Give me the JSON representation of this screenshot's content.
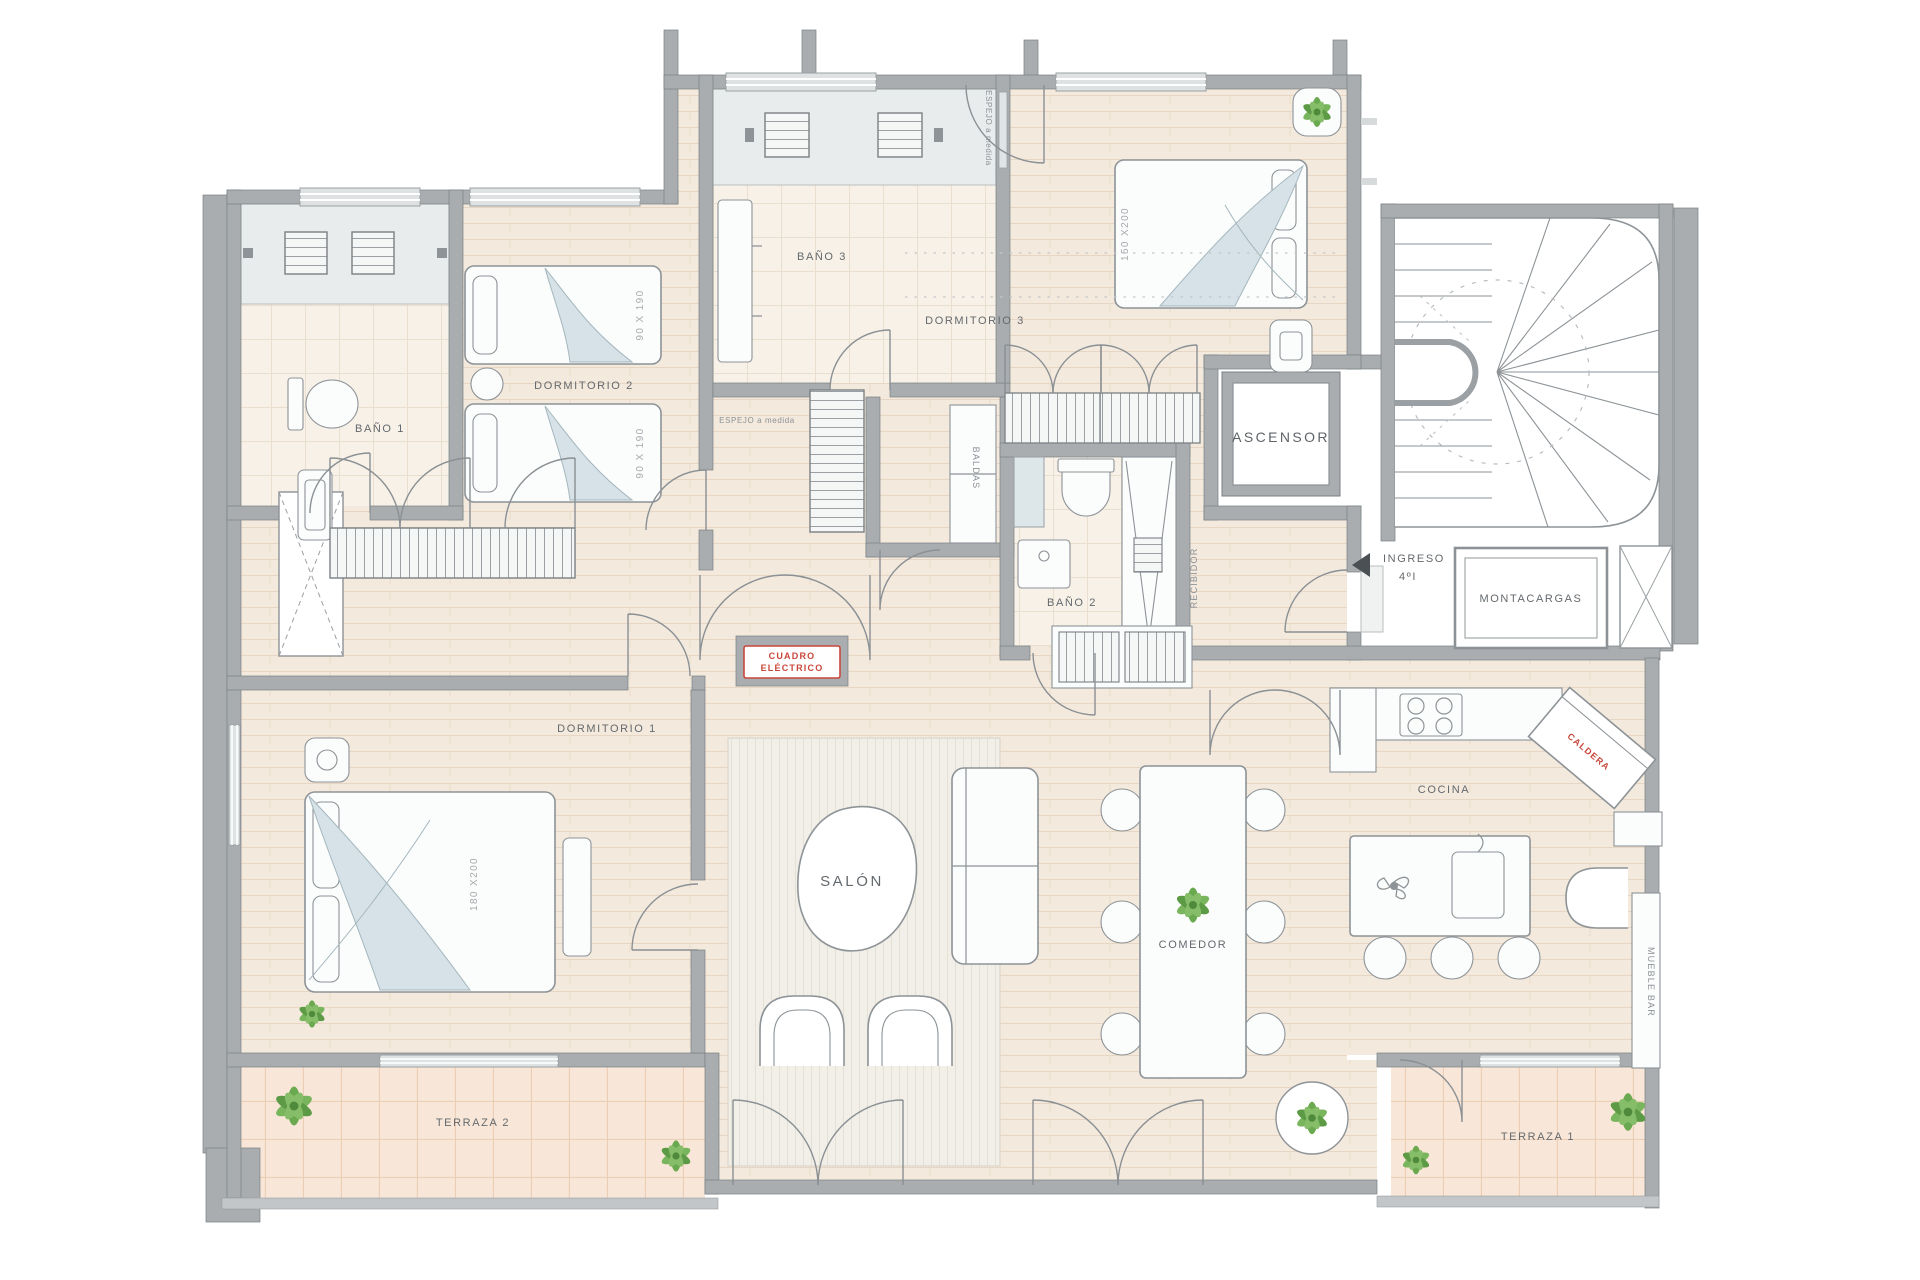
{
  "document": {
    "type": "architectural-floor-plan",
    "style": "apartment plan with furniture, Spanish labels"
  },
  "labels": {
    "bano1": "BAÑO 1",
    "bano2": "BAÑO 2",
    "bano3": "BAÑO 3",
    "dormitorio1": "DORMITORIO 1",
    "dormitorio2": "DORMITORIO 2",
    "dormitorio3": "DORMITORIO 3",
    "salon": "SALÓN",
    "comedor": "COMEDOR",
    "cocina": "COCINA",
    "terraza1": "TERRAZA 1",
    "terraza2": "TERRAZA 2",
    "recibidor": "RECIBIDOR",
    "baldas": "BALDAS",
    "ascensor": "ASCENSOR",
    "montacargas": "MONTACARGAS",
    "ingreso_line1": "INGRESO",
    "ingreso_line2": "4ºI",
    "cuadro_line1": "CUADRO",
    "cuadro_line2": "ELÉCTRICO",
    "espejo": "ESPEJO a medida",
    "caldera": "CALDERA",
    "mueble_bar": "MUEBLE BAR",
    "bed_single": "90 X 190",
    "bed_queen": "150 X200",
    "bed_king": "180 X200"
  },
  "rooms": [
    {
      "name": "Baño 1",
      "fixtures": [
        "shower",
        "toilet",
        "sink"
      ]
    },
    {
      "name": "Dormitorio 2",
      "beds": [
        "90 X 190",
        "90 X 190"
      ]
    },
    {
      "name": "Baño 3",
      "fixtures": [
        "shower",
        "vanity"
      ]
    },
    {
      "name": "Dormitorio 3",
      "beds": [
        "150 X200"
      ]
    },
    {
      "name": "Baño 2",
      "fixtures": [
        "shower",
        "toilet",
        "sink"
      ]
    },
    {
      "name": "Dormitorio 1",
      "beds": [
        "180 X200"
      ]
    },
    {
      "name": "Salón",
      "furniture": [
        "sofa",
        "coffee-table",
        "armchairs",
        "rug"
      ]
    },
    {
      "name": "Comedor",
      "furniture": [
        "dining-table",
        "6 chairs",
        "plant"
      ]
    },
    {
      "name": "Cocina",
      "furniture": [
        "hob",
        "island",
        "sink",
        "3 stools"
      ]
    },
    {
      "name": "Terraza 1",
      "furniture": [
        "plants"
      ]
    },
    {
      "name": "Terraza 2",
      "furniture": [
        "plants"
      ]
    }
  ],
  "core": [
    "ASCENSOR",
    "MONTACARGAS",
    "escalera"
  ],
  "colors": {
    "wall": "#a9adaf",
    "wall_stroke": "#7b8084",
    "floor": "#f3e9dd",
    "floor_line": "#e6d6c3",
    "bath_floor": "#f7f1e8",
    "shower": "#e9ecec",
    "rug": "#f1efe8",
    "furniture_stroke": "#8d9397",
    "fabric": "#d6e2e7",
    "terrace": "#f8e7d8",
    "terrace_line": "#eccdb5",
    "plant_green": "#6aa94f",
    "accent_red": "#c9473b",
    "label_gray": "#64696d"
  }
}
